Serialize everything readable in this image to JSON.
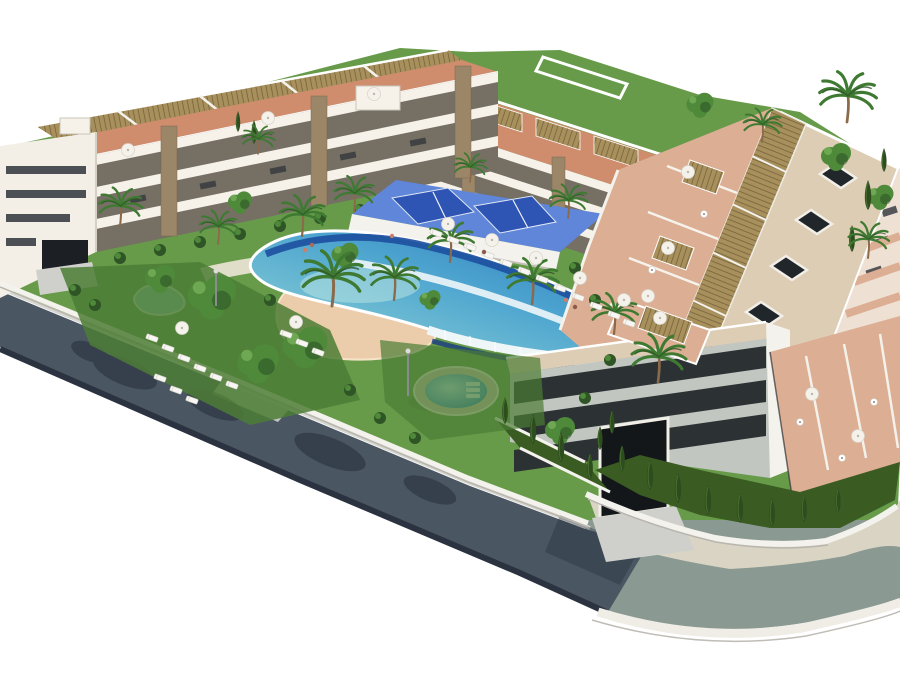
{
  "scene": {
    "title": "aerial-3d-render-apartment-complex",
    "type": "architectural-visualization",
    "description": "Aerial isometric 3D rendering of a modern Mediterranean residential complex: white apartment blocks with golden roof pergolas and terracotta roof terraces surrounding landscaped gardens with a wave-design lagoon pool, sand beach entry, round jacuzzi, kidney pool, blue padel courts, palm trees, sun loungers and parasols, wrapped by a perimeter road with sidewalks",
    "features": [
      "northwest apartment block with roof pergolas",
      "north apartment block with roof pergolas",
      "east apartment block with skylight roof and pergola strip",
      "south apartment block with dark glass facade and garage",
      "lagoon swimming pool with wave cascades",
      "sand beach entry",
      "round jacuzzi pool",
      "kidney pool",
      "padel courts",
      "gardens with palms, cypresses and lawns",
      "sun loungers and parasols",
      "perimeter road with sidewalk and curbs"
    ]
  },
  "colors": {
    "background": "#ffffff",
    "road_dark": "#4b5663",
    "road_light": "#8a9992",
    "road_shadow": "#232c38",
    "sidewalk": "#d9d4c4",
    "curb_light": "#efede6",
    "curb_dark": "#2b3340",
    "wall_white": "#f4f2ec",
    "wall_shade": "#b8b6ae",
    "facade_white": "#f6f2ea",
    "facade_shade": "#756f64",
    "facade_pink": "#efe0d4",
    "gable_white": "#f3efe7",
    "glass_dark": "#2c3134",
    "window_dark": "#30343a",
    "stone": "#9b8668",
    "pergola": "#a8905c",
    "pergola_line": "#6f5c38",
    "terracotta": "#cf8d6d",
    "terrace_salmon": "#dcae93",
    "roof_beige": "#ddcdb4",
    "path_cream": "#e7e0cf",
    "lawn": "#679b4a",
    "lawn_dark": "#4c7c35",
    "hedge": "#3a5c22",
    "tree_green": "#4e8a3a",
    "tree_light": "#7db55e",
    "tree_dark": "#2f5526",
    "cypress": "#2e4d1f",
    "palm_green": "#3f7a33",
    "trunk": "#8a6a4a",
    "pool_navy": "#1d4f9e",
    "pool_deep": "#2673bd",
    "pool_mid": "#4fa6cf",
    "pool_light": "#9adbd8",
    "cascade_white": "#eef6f8",
    "sand": "#eccdab",
    "jacuzzi_blue": "#2f86c0",
    "stone_rim": "#cfc4ae",
    "court_blue": "#2f55b4",
    "court_deck": "#5f86d8",
    "lounger": "#f7f6f2",
    "parasol": "#f4f2ea",
    "apron": "#cfd0cc",
    "skylight": "#20262a",
    "metal": "#8a8d90"
  }
}
